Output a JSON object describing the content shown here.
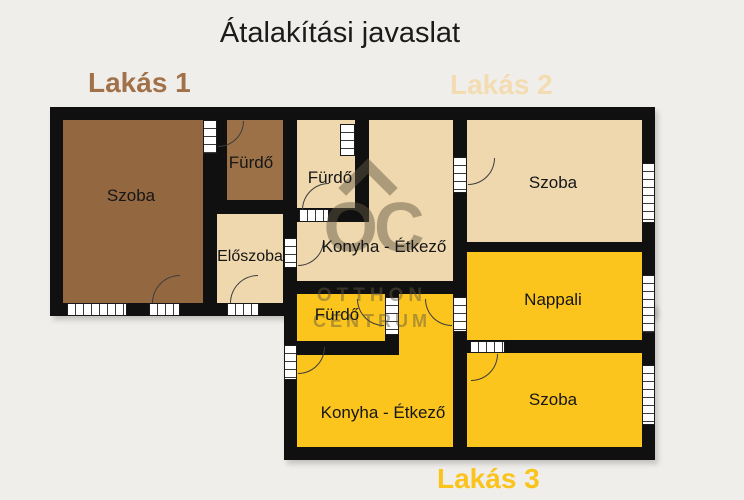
{
  "title": "Átalakítási javaslat",
  "apartments": [
    {
      "id": "lakas1",
      "label": "Lakás 1",
      "color": "#a1724a"
    },
    {
      "id": "lakas2",
      "label": "Lakás 2",
      "color": "#f3dcb1"
    },
    {
      "id": "lakas3",
      "label": "Lakás 3",
      "color": "#fbc41d"
    }
  ],
  "rooms": {
    "l1_szoba": {
      "label": "Szoba",
      "apartment": "Lakás 1"
    },
    "l1_furdo": {
      "label": "Fürdő",
      "apartment": "Lakás 1"
    },
    "eloszoba": {
      "label": "Előszoba",
      "apartment": "Lakás 2"
    },
    "l2_furdo": {
      "label": "Fürdő",
      "apartment": "Lakás 2"
    },
    "l2_konyha": {
      "label": "Konyha - Étkező",
      "apartment": "Lakás 2"
    },
    "l2_szoba": {
      "label": "Szoba",
      "apartment": "Lakás 2"
    },
    "nappali": {
      "label": "Nappali",
      "apartment": "Lakás 3"
    },
    "l3_furdo": {
      "label": "Fürdő",
      "apartment": "Lakás 3"
    },
    "l3_konyha": {
      "label": "Konyha - Étkező",
      "apartment": "Lakás 3"
    },
    "l3_szoba": {
      "label": "Szoba",
      "apartment": "Lakás 3"
    }
  },
  "watermark": {
    "logo": "OC",
    "line1": "OTTHON",
    "line2": "CENTRUM"
  },
  "colors": {
    "background": "#f0eeea",
    "wall": "#101010",
    "lakas1_fill": "#936740",
    "lakas1_furdo_fill": "#9d7147",
    "lakas2_fill": "#efd8ae",
    "lakas3_fill": "#fbc51d",
    "label_lakas1": "#a1724a",
    "label_lakas2": "#f3dcb1",
    "label_lakas3": "#fbc41d",
    "watermark": "rgba(99,88,66,0.48)"
  }
}
